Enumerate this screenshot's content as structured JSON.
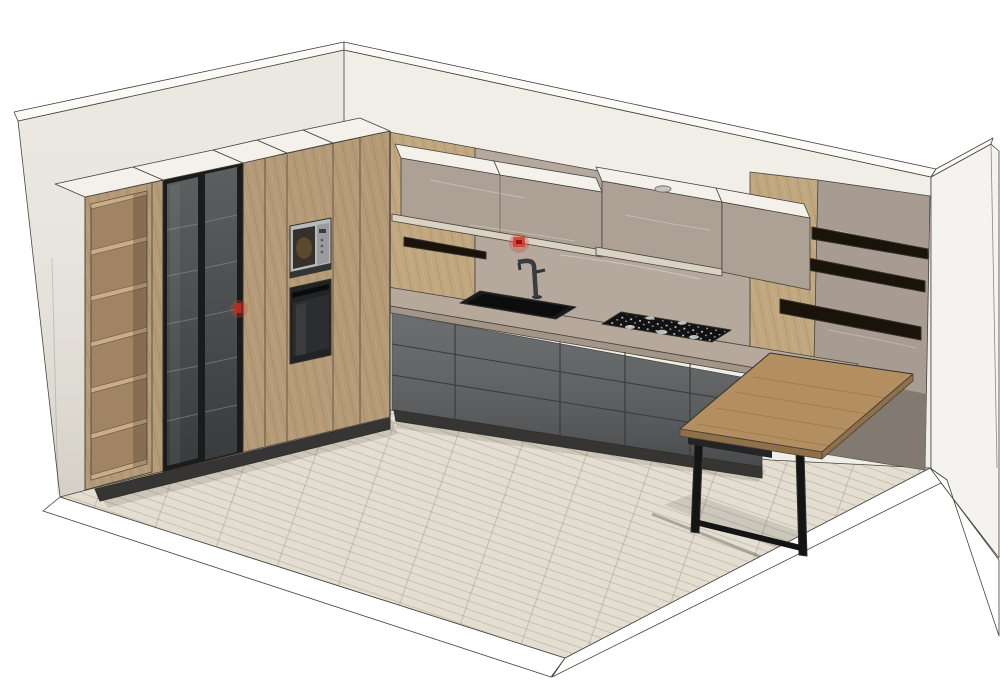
{
  "scene": {
    "type": "3d-kitchen-render",
    "counts": {
      "open_shelf_compartments": 6,
      "glass_doors": 2,
      "right_wall_shelves": 3,
      "left_wall_shelf": 1,
      "hob_burners": 5,
      "table_legs": 2,
      "red_markers": 2,
      "upper_cabinet_sections": 3
    }
  },
  "colors": {
    "wallLeft": "#ebe8e1",
    "wallBack": "#f1eee8",
    "wallRight": "#f4f3ef",
    "wallEdge": "#fbfaf7",
    "floor": "#e3ded1",
    "floorBorder": "#ffffff",
    "woodCabinet": "#b49a76",
    "woodPanel": "#c0a77f",
    "topWhite": "#f3f1ea",
    "glassFrame": "#1b1b1b",
    "glass": "#474b4c",
    "steel": "#b8b9ba",
    "microWindow": "#35302a",
    "ovenBlack": "#202223",
    "stoneCabinet": "#ada095",
    "stoneBacksplash": "#b5a89d",
    "stonePanel": "#a89b91",
    "stonePanelShadow": "#7d756d",
    "greyBase": "#5a5d5f",
    "plinth": "#363534",
    "counterTop": "#b6a89b",
    "counterFascia": "#a39587",
    "creamStrip": "#dad2c3",
    "sink": "#17191a",
    "faucet": "#3a3d3f",
    "cooktop": "#121212",
    "burner": "#d8d8d8",
    "shelfBlack": "#1a1309",
    "tableWood": "#b28e60",
    "tableEdge": "#8f7049",
    "legBlack": "#141414",
    "red": "#d93a2b"
  }
}
